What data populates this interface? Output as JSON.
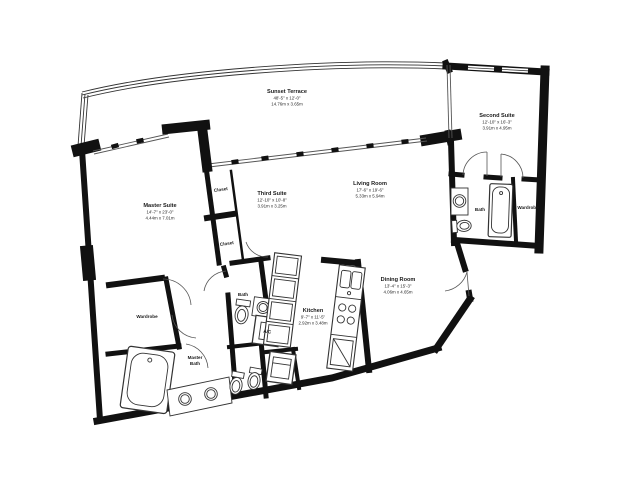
{
  "page": {
    "background": "#ffffff"
  },
  "colors": {
    "wall": "#111111",
    "thin_line": "#444444",
    "text": "#1a1a1a"
  },
  "rooms": [
    {
      "id": "sunset-terrace",
      "name": "Sunset Terrace",
      "dims_ft": "48'-5\" x 12'-0\"",
      "dims_m": "14.76m x 3.65m"
    },
    {
      "id": "second-suite",
      "name": "Second Suite",
      "dims_ft": "12'-10\" x 16'-3\"",
      "dims_m": "3.91m x 4.95m"
    },
    {
      "id": "master-suite",
      "name": "Master Suite",
      "dims_ft": "14'-7\" x 23'-0\"",
      "dims_m": "4.44m x 7.01m"
    },
    {
      "id": "third-suite",
      "name": "Third Suite",
      "dims_ft": "12'-10\" x 10'-8\"",
      "dims_m": "3.91m x 3.25m"
    },
    {
      "id": "living-room",
      "name": "Living Room",
      "dims_ft": "17'-6\" x 19'-6\"",
      "dims_m": "5.33m x 5.94m"
    },
    {
      "id": "dining-room",
      "name": "Dining Room",
      "dims_ft": "13'-4\" x 15'-3\"",
      "dims_m": "4.06m x 4.65m"
    },
    {
      "id": "kitchen",
      "name": "Kitchen",
      "dims_ft": "9'-7\" x 11'-5\"",
      "dims_m": "2.92m x 3.48m"
    }
  ],
  "labels": [
    {
      "id": "closet-upper",
      "text": "Closet"
    },
    {
      "id": "closet-lower",
      "text": "Closet"
    },
    {
      "id": "wardrobe-left",
      "text": "Wardrobe"
    },
    {
      "id": "master-bath-line1",
      "text": "Master"
    },
    {
      "id": "master-bath-line2",
      "text": "Bath"
    },
    {
      "id": "bath-center",
      "text": "Bath"
    },
    {
      "id": "ac-unit",
      "text": "A/C"
    },
    {
      "id": "bath-right",
      "text": "Bath"
    },
    {
      "id": "wardrobe-right",
      "text": "Wardrobe"
    }
  ]
}
